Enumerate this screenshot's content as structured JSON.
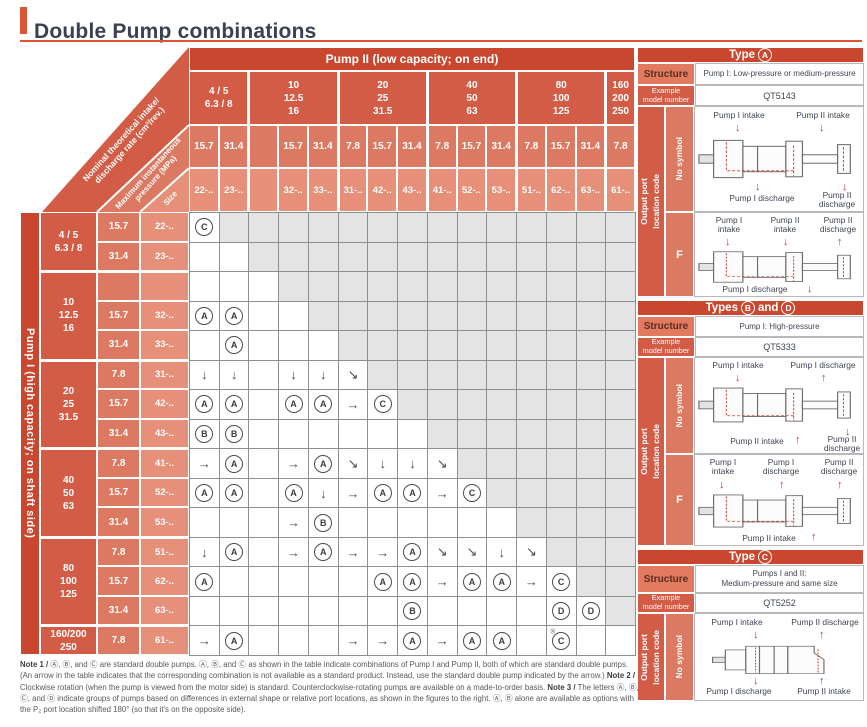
{
  "title": "Double Pump combinations",
  "colors": {
    "accent": "#dd5435",
    "header_red": "#c8472e",
    "group_red": "#d25c45",
    "pressure_red": "#dc7962",
    "size_red": "#e68f79",
    "unavailable_gray": "#e4e4e4",
    "arrow_red": "#c43a28"
  },
  "table": {
    "pump2_header": "Pump II (low capacity; on end)",
    "pump1_header": "Pump I (high capacity; on shaft side)",
    "corner": {
      "band1_line1": "Nominal theoretical intake/",
      "band1_line2": "discharge rate (cm³/rev.)",
      "band2_line1": "Maximum instantaneous",
      "band2_line2": "pressure (MPa)",
      "band3": "Size"
    },
    "col_groups": [
      {
        "label": "4 / 5\n6.3 / 8",
        "subs": [
          {
            "p": "15.7",
            "s": "22-.."
          },
          {
            "p": "31.4",
            "s": "23-.."
          }
        ]
      },
      {
        "label": "10\n12.5\n16",
        "subs": [
          {
            "p": "",
            "s": ""
          },
          {
            "p": "15.7",
            "s": "32-.."
          },
          {
            "p": "31.4",
            "s": "33-.."
          }
        ]
      },
      {
        "label": "20\n25\n31.5",
        "subs": [
          {
            "p": "7.8",
            "s": "31-.."
          },
          {
            "p": "15.7",
            "s": "42-.."
          },
          {
            "p": "31.4",
            "s": "43-.."
          }
        ]
      },
      {
        "label": "40\n50\n63",
        "subs": [
          {
            "p": "7.8",
            "s": "41-.."
          },
          {
            "p": "15.7",
            "s": "52-.."
          },
          {
            "p": "31.4",
            "s": "53-.."
          }
        ]
      },
      {
        "label": "80\n100\n125",
        "subs": [
          {
            "p": "7.8",
            "s": "51-.."
          },
          {
            "p": "15.7",
            "s": "62-.."
          },
          {
            "p": "31.4",
            "s": "63-.."
          }
        ]
      },
      {
        "label": "160\n200\n250",
        "subs": [
          {
            "p": "7.8",
            "s": "61-.."
          }
        ]
      }
    ],
    "row_groups": [
      {
        "label": "4 / 5\n6.3 / 8",
        "subs": [
          {
            "p": "15.7",
            "s": "22-.."
          },
          {
            "p": "31.4",
            "s": "23-.."
          }
        ]
      },
      {
        "label": "10\n12.5\n16",
        "subs": [
          {
            "p": "",
            "s": ""
          },
          {
            "p": "15.7",
            "s": "32-.."
          },
          {
            "p": "31.4",
            "s": "33-.."
          }
        ]
      },
      {
        "label": "20\n25\n31.5",
        "subs": [
          {
            "p": "7.8",
            "s": "31-.."
          },
          {
            "p": "15.7",
            "s": "42-.."
          },
          {
            "p": "31.4",
            "s": "43-.."
          }
        ]
      },
      {
        "label": "40\n50\n63",
        "subs": [
          {
            "p": "7.8",
            "s": "41-.."
          },
          {
            "p": "15.7",
            "s": "52-.."
          },
          {
            "p": "31.4",
            "s": "53-.."
          }
        ]
      },
      {
        "label": "80\n100\n125",
        "subs": [
          {
            "p": "7.8",
            "s": "51-.."
          },
          {
            "p": "15.7",
            "s": "62-.."
          },
          {
            "p": "31.4",
            "s": "63-.."
          }
        ]
      },
      {
        "label": "160/200\n250",
        "subs": [
          {
            "p": "7.8",
            "s": "61-.."
          }
        ]
      }
    ],
    "matrix": [
      [
        "C",
        "x",
        "x",
        "x",
        "x",
        "x",
        "x",
        "x",
        "x",
        "x",
        "x",
        "x",
        "x",
        "x",
        "x"
      ],
      [
        "",
        "",
        "x",
        "x",
        "x",
        "x",
        "x",
        "x",
        "x",
        "x",
        "x",
        "x",
        "x",
        "x",
        "x"
      ],
      [
        "",
        "",
        "",
        "x",
        "x",
        "x",
        "x",
        "x",
        "x",
        "x",
        "x",
        "x",
        "x",
        "x",
        "x"
      ],
      [
        "A",
        "A",
        "",
        "",
        "x",
        "x",
        "x",
        "x",
        "x",
        "x",
        "x",
        "x",
        "x",
        "x",
        "x"
      ],
      [
        "",
        "A",
        "",
        "",
        "",
        "x",
        "x",
        "x",
        "x",
        "x",
        "x",
        "x",
        "x",
        "x",
        "x"
      ],
      [
        "↓",
        "↓",
        "",
        "↓",
        "↓",
        "↘",
        "x",
        "x",
        "x",
        "x",
        "x",
        "x",
        "x",
        "x",
        "x"
      ],
      [
        "A",
        "A",
        "",
        "A",
        "A",
        "→",
        "C",
        "x",
        "x",
        "x",
        "x",
        "x",
        "x",
        "x",
        "x"
      ],
      [
        "B",
        "B",
        "",
        "",
        "",
        "",
        "",
        "",
        "x",
        "x",
        "x",
        "x",
        "x",
        "x",
        "x"
      ],
      [
        "→",
        "A",
        "",
        "→",
        "A",
        "↘",
        "↓",
        "↓",
        "↘",
        "x",
        "x",
        "x",
        "x",
        "x",
        "x"
      ],
      [
        "A",
        "A",
        "",
        "A",
        "↓",
        "→",
        "A",
        "A",
        "→",
        "C",
        "x",
        "x",
        "x",
        "x",
        "x"
      ],
      [
        "",
        "",
        "",
        "→",
        "B",
        "",
        "",
        "",
        "",
        "",
        "",
        "x",
        "x",
        "x",
        "x"
      ],
      [
        "↓",
        "A",
        "",
        "→",
        "A",
        "→",
        "→",
        "A",
        "↘",
        "↘",
        "↓",
        "↘",
        "x",
        "x",
        "x"
      ],
      [
        "A",
        "",
        "",
        "",
        "",
        "",
        "A",
        "A",
        "→",
        "A",
        "A",
        "→",
        "C",
        "x",
        "x"
      ],
      [
        "",
        "",
        "",
        "",
        "",
        "",
        "",
        "B",
        "",
        "",
        "",
        "",
        "D",
        "D",
        "x"
      ],
      [
        "→",
        "A",
        "",
        "",
        "",
        "→",
        "→",
        "A",
        "→",
        "A",
        "A",
        "",
        "C*",
        "",
        ""
      ]
    ]
  },
  "panels": [
    {
      "title": {
        "pre": "Type",
        "l1": "A"
      },
      "structure_label": "Structure",
      "structure_value": "Pump I: Low-pressure or medium-pressure",
      "example_label": "Example\nmodel number",
      "example_value": "QT5143",
      "output_label": "Output port\nlocation code",
      "variants": [
        {
          "code": "No symbol",
          "labels": {
            "tl": "Pump I intake",
            "tr": "Pump II intake",
            "bl": "Pump I discharge",
            "br": "Pump II\ndischarge"
          }
        },
        {
          "code": "F",
          "labels": {
            "tl": "Pump I\nintake",
            "tm": "Pump II\nintake",
            "tr": "Pump II\ndischarge",
            "bl": "Pump I discharge"
          }
        }
      ]
    },
    {
      "title": {
        "pre": "Types",
        "l1": "B",
        "mid": "and",
        "l2": "D"
      },
      "structure_label": "Structure",
      "structure_value": "Pump I: High-pressure",
      "example_label": "Example\nmodel number",
      "example_value": "QT5333",
      "output_label": "Output port\nlocation code",
      "variants": [
        {
          "code": "No symbol",
          "labels": {
            "tl": "Pump I intake",
            "tr": "Pump I discharge",
            "bm": "Pump II intake",
            "br": "Pump II\ndischarge"
          }
        },
        {
          "code": "F",
          "labels": {
            "tl": "Pump I\nintake",
            "tm": "Pump I\ndischarge",
            "tr": "Pump II\ndischarge",
            "bm": "Pump II intake"
          }
        }
      ]
    },
    {
      "title": {
        "pre": "Type",
        "l1": "C"
      },
      "structure_label": "Structure",
      "structure_value": "Pumps I and II:\nMedium-pressure and same size",
      "example_label": "Example\nmodel number",
      "example_value": "QT5252",
      "output_label": "Output port\nlocation code",
      "variants": [
        {
          "code": "No symbol",
          "labels": {
            "tl": "Pump I intake",
            "tr": "Pump II discharge",
            "bl": "Pump I discharge",
            "br": "Pump II intake"
          }
        }
      ]
    }
  ],
  "notes": {
    "n1": {
      "label": "Note 1 /",
      "text": " Ⓐ, Ⓑ, and Ⓒ are standard double pumps. Ⓐ, Ⓑ, and Ⓒ as shown in the table indicate combinations of Pump I and Pump II, both of which are standard double pumps. (An arrow in the table indicates that the corresponding combination is not available as a standard product. Instead, use the standard double pump indicated by the arrow.) "
    },
    "n2": {
      "label": "Note 2 /",
      "text": " Clockwise rotation (when the pump is viewed from the motor side) is standard. Counterclockwise-rotating pumps are available on a made-to-order basis. "
    },
    "n3": {
      "label": "Note 3 /",
      "text": " The letters Ⓐ, Ⓑ, Ⓒ, and Ⓓ indicate groups of pumps based on differences in external shape or relative port locations, as shown in the figures to the right. Ⓐ, Ⓑ alone are available as options with the P₂ port location shifted 180° (so that it's on the opposite side)."
    }
  }
}
